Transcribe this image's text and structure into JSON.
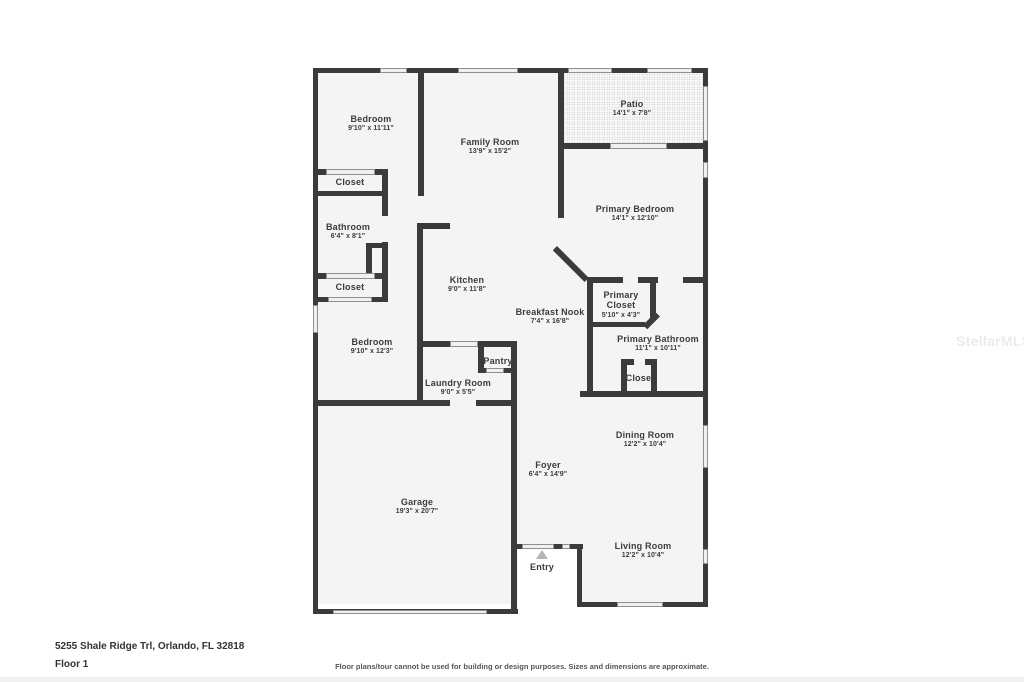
{
  "page": {
    "address": "5255 Shale Ridge Trl, Orlando, FL 32818",
    "floor_label": "Floor 1",
    "disclaimer": "Floor plans/tour cannot be used for building or design purposes. Sizes and dimensions are approximate.",
    "watermark": "StellarMLS"
  },
  "colors": {
    "wall": "#3b3b3b",
    "floor_fill": "#f4f4f4",
    "window_fill": "#f0f0f0",
    "label_text": "#3b3b3b",
    "entry_marker": "#b5b5b5"
  },
  "rooms": [
    {
      "name": "Bedroom",
      "dims": "9'10\" x 11'11\""
    },
    {
      "name": "Family Room",
      "dims": "13'9\" x 15'2\""
    },
    {
      "name": "Patio",
      "dims": "14'1\" x 7'8\""
    },
    {
      "name": "Primary Bedroom",
      "dims": "14'1\" x 12'10\""
    },
    {
      "name": "Closet",
      "dims": ""
    },
    {
      "name": "Bathroom",
      "dims": "6'4\" x 8'1\""
    },
    {
      "name": "Closet",
      "dims": ""
    },
    {
      "name": "Kitchen",
      "dims": "9'0\" x 11'8\""
    },
    {
      "name": "Breakfast Nook",
      "dims": "7'4\" x 16'8\""
    },
    {
      "name": "Primary Closet",
      "dims": "5'10\" x 4'3\""
    },
    {
      "name": "Primary Bathroom",
      "dims": "11'1\" x 10'11\""
    },
    {
      "name": "Bedroom",
      "dims": "9'10\" x 12'3\""
    },
    {
      "name": "Pantry",
      "dims": ""
    },
    {
      "name": "Laundry Room",
      "dims": "9'0\" x 5'5\""
    },
    {
      "name": "Closet",
      "dims": ""
    },
    {
      "name": "Dining Room",
      "dims": "12'2\" x 10'4\""
    },
    {
      "name": "Foyer",
      "dims": "6'4\" x 14'9\""
    },
    {
      "name": "Garage",
      "dims": "19'3\" x 20'7\""
    },
    {
      "name": "Living Room",
      "dims": "12'2\" x 10'4\""
    },
    {
      "name": "Entry",
      "dims": ""
    }
  ]
}
